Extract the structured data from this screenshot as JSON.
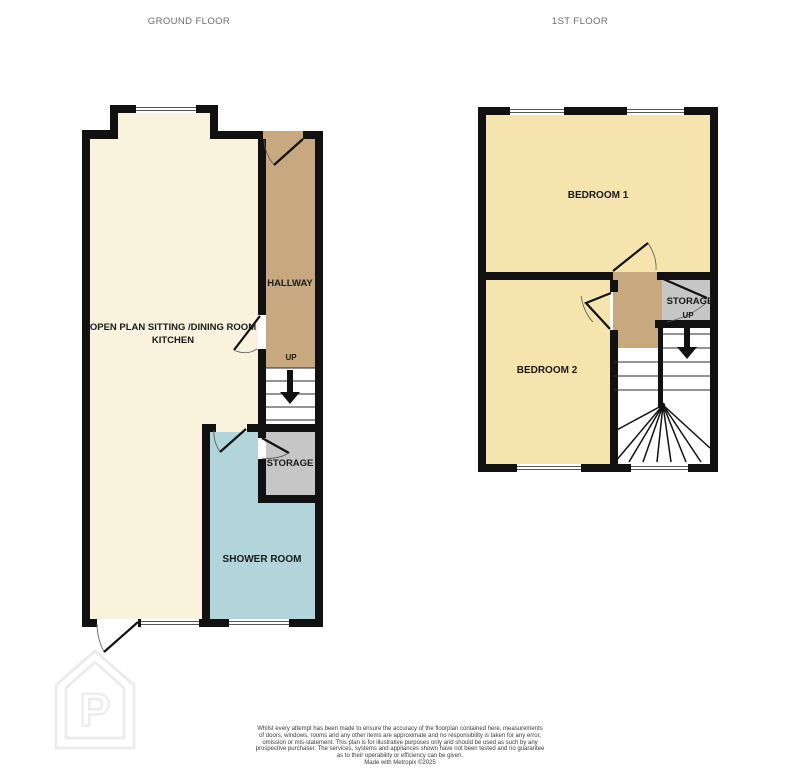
{
  "titles": {
    "ground_floor": "GROUND FLOOR",
    "first_floor": "1ST FLOOR"
  },
  "ground_floor": {
    "rooms": {
      "open_plan_line1": "OPEN PLAN SITTING /DINING ROOM",
      "open_plan_line2": "KITCHEN",
      "hallway": "HALLWAY",
      "storage": "STORAGE",
      "shower_room": "SHOWER ROOM"
    },
    "stairs_label": "UP"
  },
  "first_floor": {
    "rooms": {
      "bedroom1": "BEDROOM 1",
      "bedroom2": "BEDROOM 2",
      "storage": "STORAGE"
    },
    "stairs_label": "UP"
  },
  "colors": {
    "wall": "#111111",
    "living_cream": "#f9f2dd",
    "bedroom_yellow": "#f6e4ae",
    "hallway_tan": "#c8a87e",
    "shower_blue": "#b2d5db",
    "storage_grey": "#c6c6c6",
    "title_text": "#6b6b6b",
    "label_text": "#1a1a1a"
  },
  "watermark": {
    "letter": "P"
  },
  "footer": {
    "lines": [
      "Whilst every attempt has been made to ensure the accuracy of the floorplan contained here, measurements",
      "of doors, windows, rooms and any other items are approximate and no responsibility is taken for any error,",
      "omission or mis-statement. This plan is for illustrative purposes only and should be used as such by any",
      "prospective purchaser. The services, systems and appliances shown have not been tested and no guarantee",
      "as to their operability or efficiency can be given."
    ],
    "credit": "Made with Metropix ©2025"
  }
}
